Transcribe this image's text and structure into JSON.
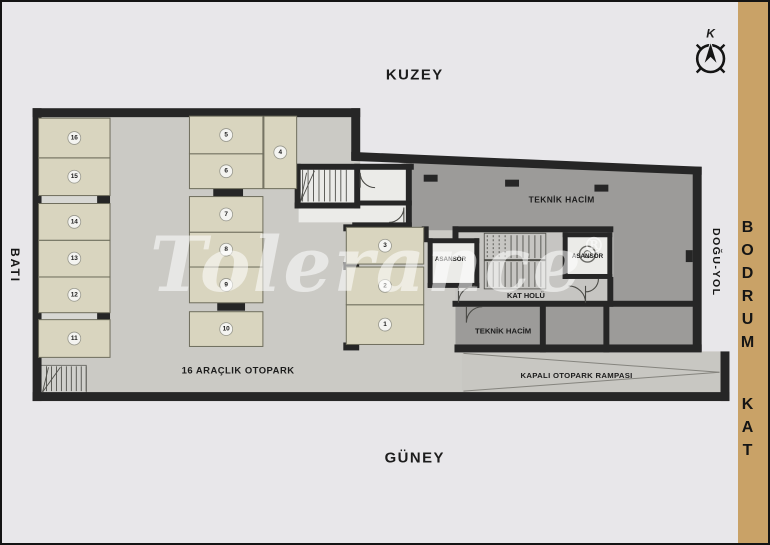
{
  "strip": {
    "text": "BODRUM KAT",
    "color": "#c9a267"
  },
  "compass": {
    "label": "K"
  },
  "directions": {
    "north": "KUZEY",
    "south": "GÜNEY",
    "west": "BATI",
    "east": "DOĞU-YOL"
  },
  "watermark": {
    "text": "Tolerance",
    "reg": "®"
  },
  "plan": {
    "labels": {
      "teknik_hacim_main": "TEKNİK HACİM",
      "teknik_hacim_small": "TEKNİK HACİM",
      "asansor_left": "ASANSÖR",
      "asansor_right": "ASANSÖR",
      "kat_holu": "KAT HOLÜ",
      "otopark_caption": "16 ARAÇLIK OTOPARK",
      "rampa": "KAPALI OTOPARK RAMPASI"
    },
    "parking_spots": [
      {
        "n": "1",
        "x": 346,
        "y": 305,
        "w": 78,
        "h": 40
      },
      {
        "n": "2",
        "x": 346,
        "y": 267,
        "w": 78,
        "h": 38
      },
      {
        "n": "3",
        "x": 346,
        "y": 227,
        "w": 78,
        "h": 37
      },
      {
        "n": "4",
        "x": 263,
        "y": 115,
        "w": 33,
        "h": 73
      },
      {
        "n": "5",
        "x": 188,
        "y": 115,
        "w": 74,
        "h": 38
      },
      {
        "n": "6",
        "x": 188,
        "y": 153,
        "w": 74,
        "h": 35
      },
      {
        "n": "7",
        "x": 188,
        "y": 196,
        "w": 74,
        "h": 36
      },
      {
        "n": "8",
        "x": 188,
        "y": 232,
        "w": 74,
        "h": 35
      },
      {
        "n": "9",
        "x": 188,
        "y": 267,
        "w": 74,
        "h": 36
      },
      {
        "n": "10",
        "x": 188,
        "y": 312,
        "w": 74,
        "h": 35
      },
      {
        "n": "11",
        "x": 36,
        "y": 320,
        "w": 72,
        "h": 38
      },
      {
        "n": "12",
        "x": 36,
        "y": 277,
        "w": 72,
        "h": 36
      },
      {
        "n": "13",
        "x": 36,
        "y": 240,
        "w": 72,
        "h": 37
      },
      {
        "n": "14",
        "x": 36,
        "y": 203,
        "w": 72,
        "h": 37
      },
      {
        "n": "15",
        "x": 36,
        "y": 157,
        "w": 72,
        "h": 38
      },
      {
        "n": "16",
        "x": 36,
        "y": 117,
        "w": 72,
        "h": 40
      }
    ]
  },
  "colors": {
    "background": "#e8e7ea",
    "walls": "#262626",
    "garage_floor": "#cbcac5",
    "dark_room": "#9c9b99",
    "hall_floor": "#c6c5c2",
    "white_room": "#ebebe8",
    "parking_spot": "#d9d5bf",
    "side_strip": "#c9a267",
    "watermark": "rgba(255,255,255,0.55)"
  }
}
